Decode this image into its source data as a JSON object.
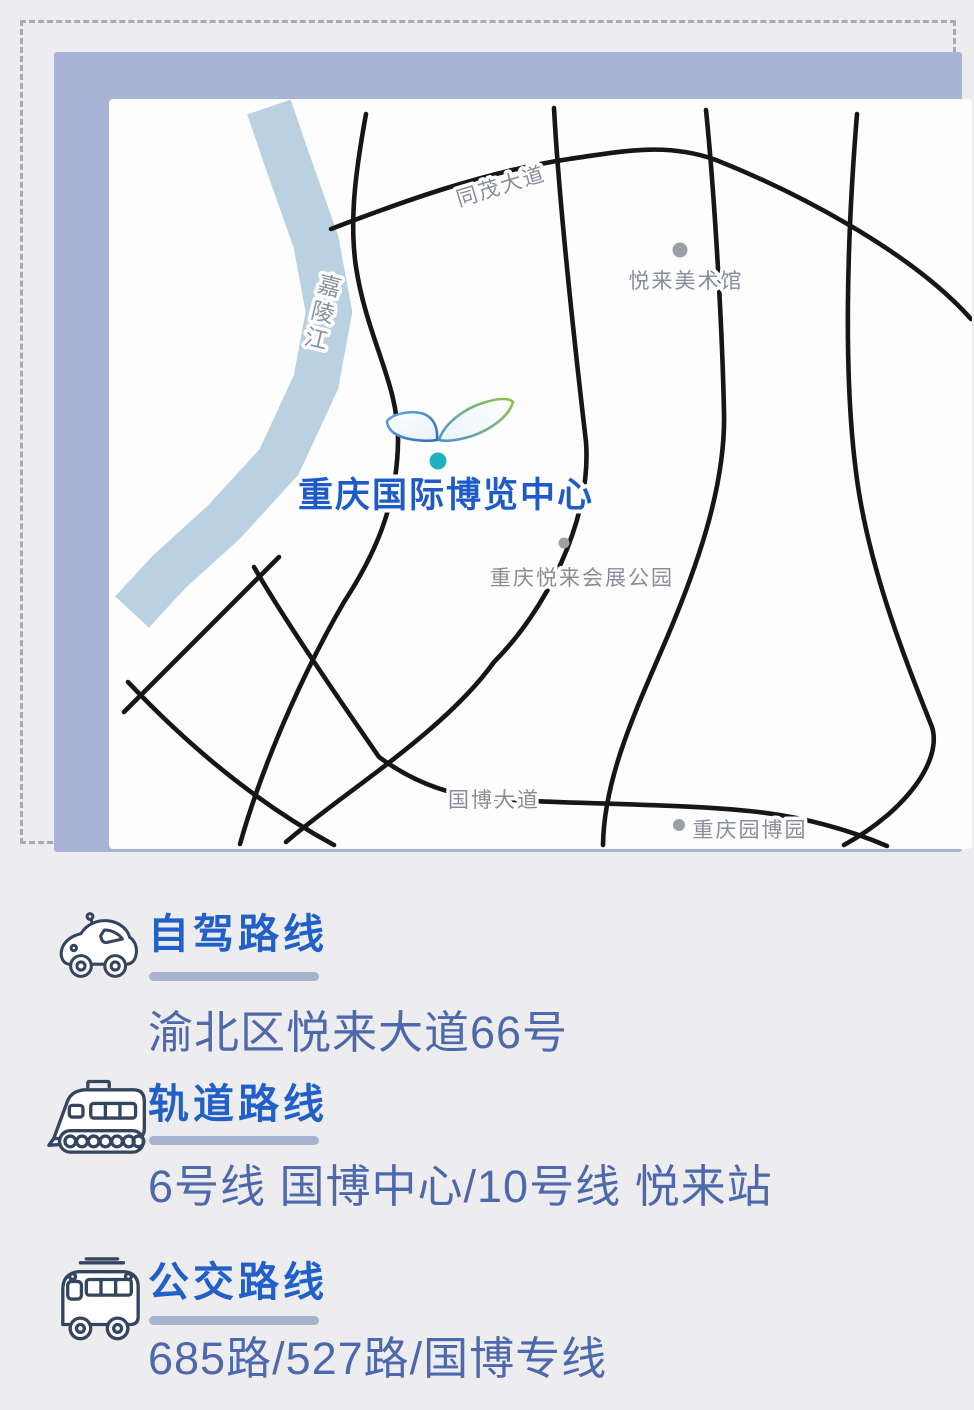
{
  "map": {
    "river": {
      "label": "嘉陵江",
      "color": "#bad1e2"
    },
    "road_labels": {
      "tongmao": "同茂大道",
      "guobo": "国博大道"
    },
    "road_color": "#161616",
    "pois": [
      {
        "name": "悦来美术馆"
      },
      {
        "name": "重庆悦来会展公园"
      },
      {
        "name": "重庆园博园"
      }
    ],
    "venue": {
      "name": "重庆国际博览中心",
      "label_color": "#1d5bc9",
      "marker_color": "#1fb1c1"
    },
    "frame_color": "#a9b3d5",
    "dashed_border_color": "#a6abb2"
  },
  "sections": [
    {
      "icon": "car-icon",
      "title": "自驾路线",
      "detail": "渝北区悦来大道66号"
    },
    {
      "icon": "train-icon",
      "title": "轨道路线",
      "detail": "6号线 国博中心/10号线 悦来站"
    },
    {
      "icon": "bus-icon",
      "title": "公交路线",
      "detail": "685路/527路/国博专线"
    }
  ],
  "colors": {
    "title_blue": "#2060c8",
    "body_blue": "#4d68ac",
    "underline": "#a7b2cf",
    "page_bg": "#ededef"
  }
}
